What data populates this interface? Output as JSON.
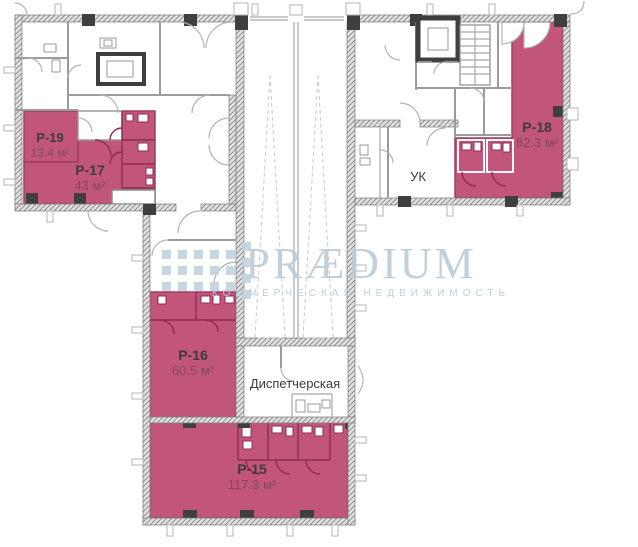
{
  "watermark": {
    "brand": "PRÆDIUM",
    "tagline": "КОММЕРЧЕСКАЯ НЕДВИЖИМОСТЬ"
  },
  "rooms": {
    "p19": {
      "name": "P-19",
      "area": "13.4 м²"
    },
    "p17": {
      "name": "P-17",
      "area": "43 м²"
    },
    "p18": {
      "name": "P-18",
      "area": "82.3 м²"
    },
    "p16": {
      "name": "P-16",
      "area": "60.5 м²"
    },
    "p15": {
      "name": "P-15",
      "area": "117.3 м²"
    },
    "uk": {
      "name": "УК"
    },
    "dispatcher": {
      "name": "Диспетчерская"
    }
  },
  "colors": {
    "highlight_fill": "#c2567a",
    "highlight_border": "#a23b61",
    "wall_dark": "#3f3f3f",
    "watermark_blue": "#bccbd8"
  }
}
